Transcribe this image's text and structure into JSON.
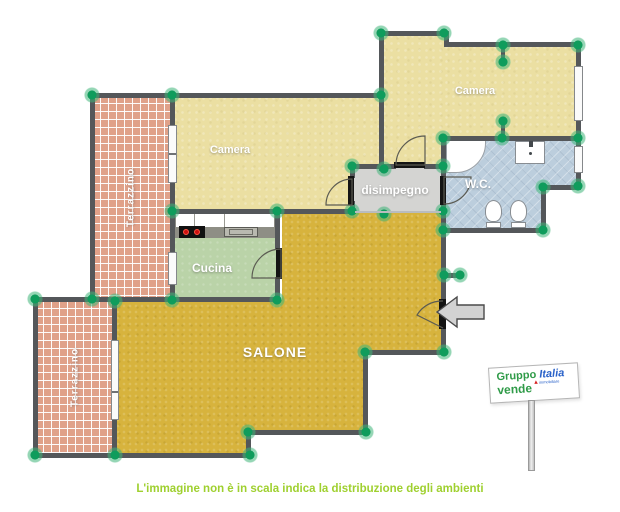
{
  "plan": {
    "rooms": {
      "camera1": {
        "label": "Camera"
      },
      "camera2": {
        "label": "Camera"
      },
      "terrazzino1": {
        "label": "Terrazzino"
      },
      "terrazzino2": {
        "label": "Terrazzino"
      },
      "disimpegno": {
        "label": "disimpegno"
      },
      "wc": {
        "label": "W.C."
      },
      "cucina": {
        "label": "Cucina"
      },
      "salone": {
        "label": "SALONE"
      }
    },
    "caption": "L'immagine non è in scala indica la distribuzione degli ambienti",
    "sign": {
      "brand_word1": "Gruppo",
      "brand_word2": "Italia",
      "brand_sub": "immobiliare",
      "action_word": "vende"
    },
    "colors": {
      "wall": "#54575a",
      "camera_floor": "#ebdfa2",
      "salone_floor": "#d7b33d",
      "cucina_floor": "#bad3a8",
      "wc_floor": "#bccedd",
      "disimpegno_floor": "#d4d4d2",
      "terrazzino_tile": "#e0a189",
      "corner_marker": "#0f9c5c",
      "caption_text": "#9fd02f",
      "sign_green": "#2f9b48",
      "sign_blue": "#2a62c9",
      "sign_red": "#d62020"
    }
  }
}
